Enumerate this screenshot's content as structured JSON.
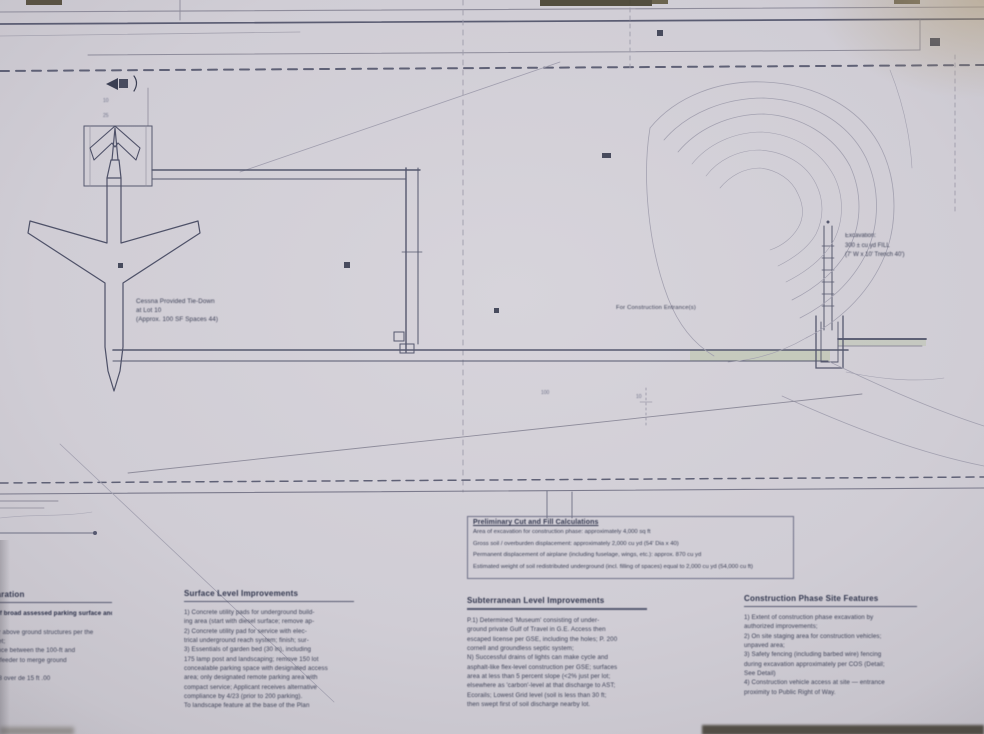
{
  "photo": {
    "paper_color": "#d2cfd6",
    "line_color": "#55586e",
    "highlight_green": "#b7c3a2",
    "ink_color": "#3d4157"
  },
  "plan": {
    "airplane_label": {
      "lines": [
        "Cessna Provided Tie-Down",
        "at Lot 10",
        "(Approx. 100 SF Spaces 44)"
      ]
    },
    "entrance_note": "For Construction Entrance(s)",
    "excavation_note": {
      "lines": [
        "Excavation:",
        "300 ± cu yd FILL",
        "(7' W x 10' Trench 40')"
      ]
    },
    "dim_labels": [
      {
        "text": "10"
      },
      {
        "text": "25"
      },
      {
        "text": "100"
      },
      {
        "text": "10"
      }
    ]
  },
  "cutfill_box": {
    "title": "Preliminary Cut and Fill Calculations",
    "lines": [
      "Area of excavation for construction phase: approximately 4,000 sq ft",
      "Gross soil / overburden displacement: approximately 2,000 cu yd (54' Dia x 40)",
      "Permanent displacement of airplane (including fuselage, wings, etc.): approx. 870 cu yd",
      "Estimated weight of soil redistributed underground (incl. filling of spaces) equal to 2,000 cu yd (54,000 cu ft)"
    ]
  },
  "columns": [
    {
      "heading": "Site Preparation",
      "lines": [
        "1) Removal of broad assessed parking surface and",
        "grading;",
        "2) Clearing for above ground structures per the",
        "erosion blanket;",
        "3) Sight distance between the 100-ft and",
        "4) As-needed feeder to merge ground",
        "surfaces;",
        "Datum: +03 48 over de 15 ft .00"
      ]
    },
    {
      "heading": "Surface Level Improvements",
      "lines": [
        "1) Concrete utility pads for underground build-",
        "ing area (start with diesel surface; remove ap-",
        "2) Concrete utility pad for service with elec-",
        "trical underground reach system; finish; sur-",
        "3) Essentials of garden bed (30 in), including",
        "175 lamp post and landscaping; remove 150 lot",
        "concealable parking space with designated access",
        "area; only designated remote parking area with",
        "compact service; Applicant receives alternative",
        "compliance by 4/23 (prior to 200 parking).",
        "To landscape feature at the base of the Plan"
      ]
    },
    {
      "heading": "Subterranean Level Improvements",
      "lines": [
        "P.1) Determined 'Museum' consisting of under-",
        "ground private Gulf of Travel in G.E. Access then",
        "escaped license per GSE, including the holes; P. 200",
        "cornell and groundless septic system;",
        "N) Successful drains of lights can make cycle and",
        "asphalt-like flex-level construction per GSE; surfaces",
        "area at less than 5 percent slope (<2% just per lot;",
        "elsewhere as 'carbon'-level at that discharge to AST;",
        "Ecorails; Lowest Grid level (soil is less than 30 ft;",
        "then swept first of soil discharge nearby lot."
      ]
    },
    {
      "heading": "Construction Phase Site Features",
      "lines": [
        "1) Extent of construction phase excavation by",
        "authorized improvements;",
        "2) On site staging area for construction vehicles;",
        "unpaved area;",
        "3) Safety fencing (including barbed wire) fencing",
        "during excavation approximately per COS (Detail;",
        "See Detail)",
        "4) Construction vehicle access at site — entrance",
        "proximity to Public Right of Way."
      ]
    }
  ]
}
